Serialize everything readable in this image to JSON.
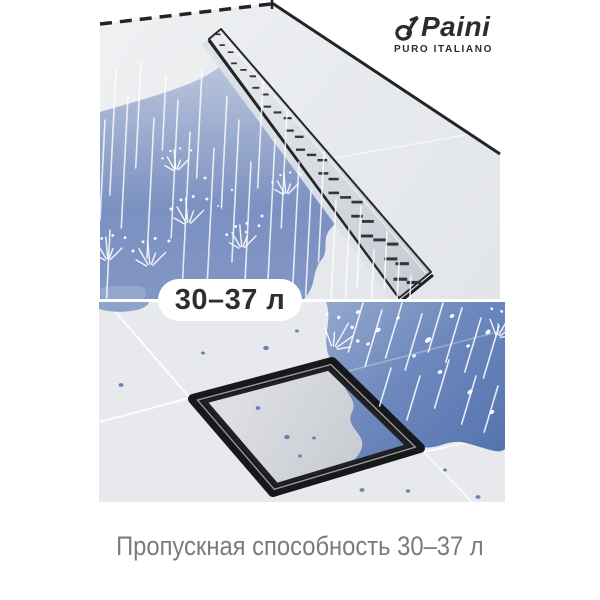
{
  "brand": {
    "name": "Paini",
    "tagline": "PURO ITALIANO"
  },
  "badge": {
    "label": "30–37 л"
  },
  "caption": {
    "text": "Пропускная способность 30–37 л"
  },
  "colors": {
    "water_light": "#b8c3db",
    "water_mid": "#7189bd",
    "water_deep": "#5372ae",
    "tile_gray": "#e7e9ec",
    "drain_outline": "#26272b",
    "frame_black": "#17181b",
    "badge_bg": "#ffffff",
    "badge_text": "#2d2e31",
    "caption_text": "#7a7b7e",
    "logo_color": "#2b2c2f"
  }
}
